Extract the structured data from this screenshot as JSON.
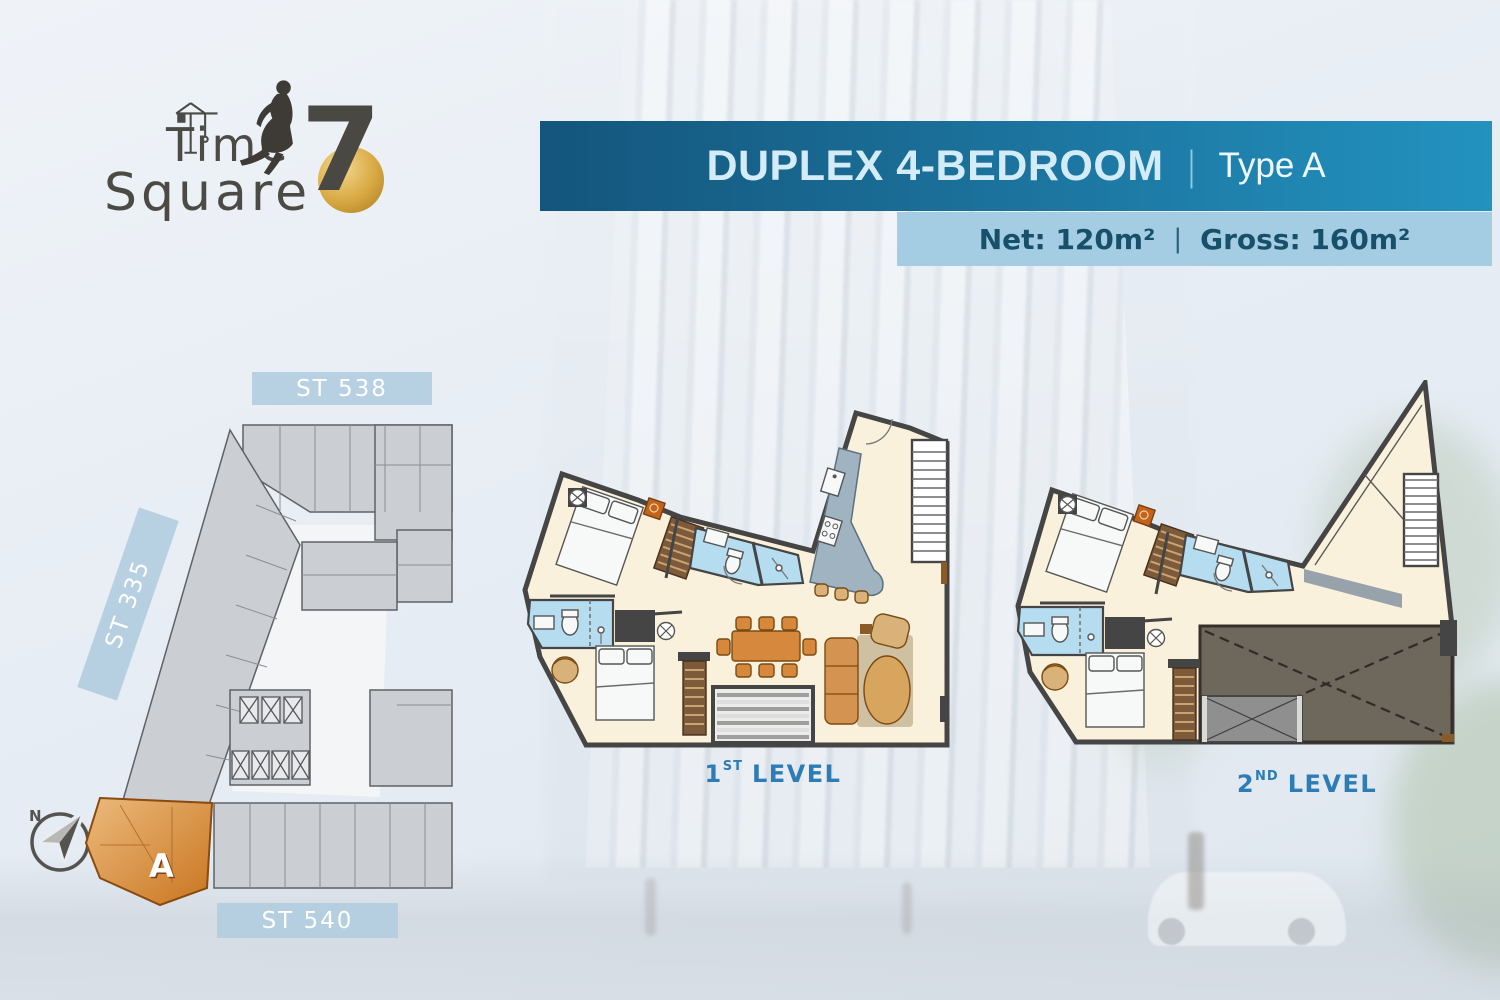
{
  "logo": {
    "word1": "Time",
    "word2": "Square",
    "number": "7"
  },
  "banner": {
    "title": "DUPLEX 4-BEDROOM",
    "divider": "|",
    "subtitle": "Type A"
  },
  "area": {
    "net": "Net: 120m²",
    "divider": "|",
    "gross": "Gross: 160m²"
  },
  "keyplan": {
    "street_top": "ST 538",
    "street_left": "ST 335",
    "street_bottom": "ST 540",
    "unit": "A",
    "compass": "N"
  },
  "levels": [
    {
      "num": "1",
      "ordinal": "ST",
      "word": "LEVEL"
    },
    {
      "num": "2",
      "ordinal": "ND",
      "word": "LEVEL"
    }
  ],
  "colors": {
    "banner_dark": "#14557c",
    "banner_light": "#2392bf",
    "banner_text": "#d3ecf8",
    "area_bg": "#a4cde3",
    "area_text": "#17506b",
    "chip_bg": "#b2cddf",
    "level_text": "#2d7cb5",
    "unit_orange": "#d6893c",
    "floor_cream": "#faf1dd",
    "wall_gray": "#454545",
    "bath_blue": "#b5dcef",
    "void_brown": "#6e675c",
    "gold": "#d8a843"
  }
}
